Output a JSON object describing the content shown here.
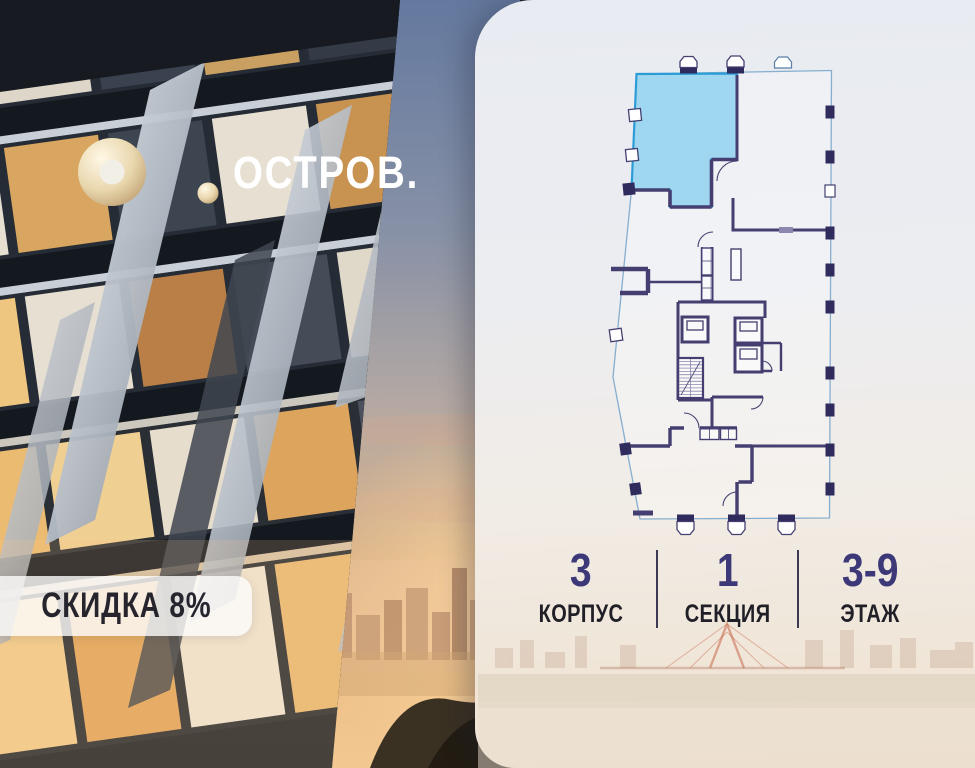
{
  "brand": {
    "logo_text": "ОСТРОВ."
  },
  "badge": {
    "discount_label": "СКИДКА 8%"
  },
  "floor_plan": {
    "highlighted_unit_color": "#9ed7ef",
    "highlighted_unit_stroke": "#2b9cd6",
    "wall_color": "#443f70",
    "outline_color": "#86aecf"
  },
  "info": {
    "items": [
      {
        "value": "3",
        "label": "КОРПУС"
      },
      {
        "value": "1",
        "label": "СЕКЦИЯ"
      },
      {
        "value": "3-9",
        "label": "ЭТАЖ"
      }
    ]
  }
}
